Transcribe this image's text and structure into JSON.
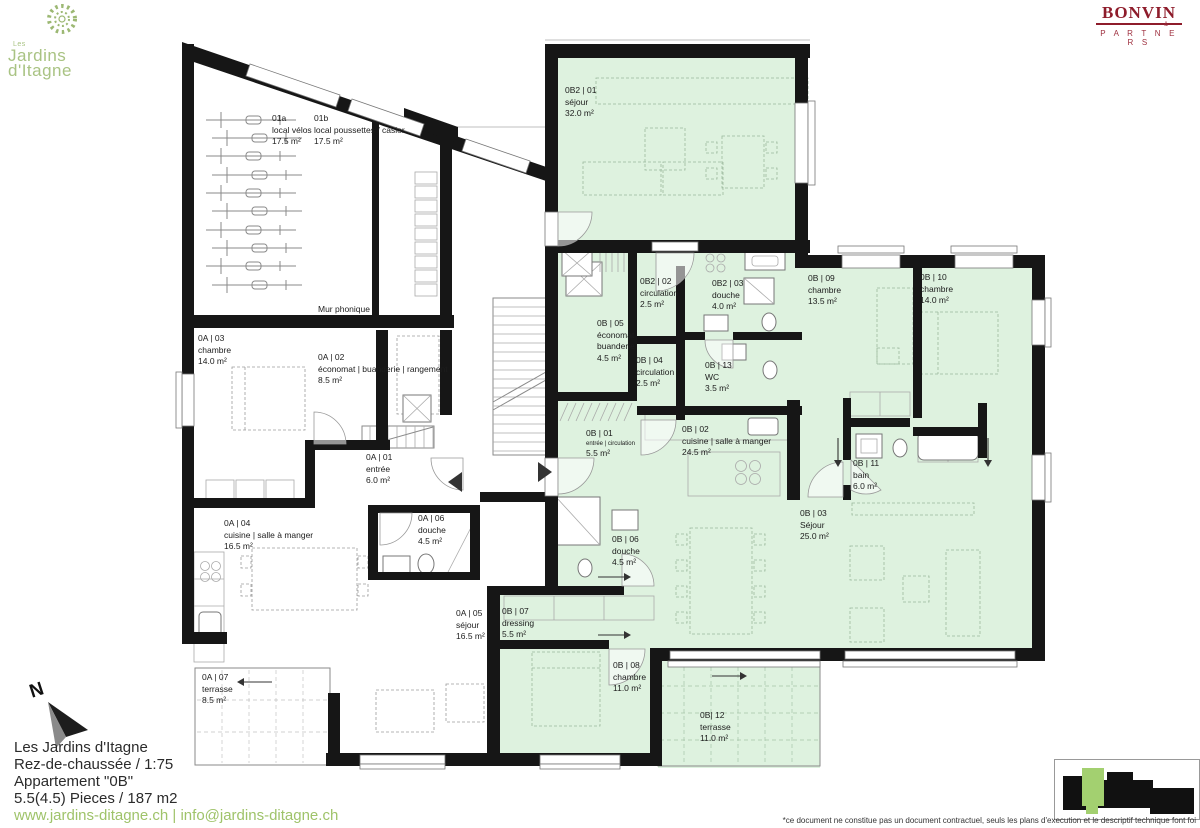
{
  "branding": {
    "site": {
      "prefix": "Les",
      "line1": "Jardins",
      "line2": "d'Itagne"
    },
    "architect": {
      "name": "BONVIN",
      "amp": "&",
      "sub": "P A R T N E R S"
    }
  },
  "title_block": {
    "project": "Les Jardins d'Itagne",
    "floor_scale": "Rez-de-chaussée / 1:75",
    "apartment": "Appartement \"0B\"",
    "size": "5.5(4.5) Pieces / 187 m2",
    "contact": "www.jardins-ditagne.ch | info@jardins-ditagne.ch"
  },
  "disclaimer": "*ce document ne constitue pas un document contractuel, seuls les plans d'execution et le descriptif technique font foi",
  "plan": {
    "north_label": "N",
    "wall_note": "Mur phonique",
    "rooms": [
      {
        "code": "01a",
        "name": "local vélos",
        "area": "17.5 m²"
      },
      {
        "code": "01b",
        "name": "local poussettes / casier",
        "area": "17.5 m²"
      },
      {
        "code": "0A | 03",
        "name": "chambre",
        "area": "14.0 m²"
      },
      {
        "code": "0A | 02",
        "name": "économat | buanderie | rangement",
        "area": "8.5 m²"
      },
      {
        "code": "0A | 01",
        "name": "entrée",
        "area": "6.0 m²"
      },
      {
        "code": "0A | 04",
        "name": "cuisine | salle à manger",
        "area": "16.5 m²"
      },
      {
        "code": "0A | 06",
        "name": "douche",
        "area": "4.5 m²"
      },
      {
        "code": "0A | 05",
        "name": "séjour",
        "area": "16.5 m²"
      },
      {
        "code": "0A | 07",
        "name": "terrasse",
        "area": "8.5 m²"
      },
      {
        "code": "0B2 | 01",
        "name": "séjour",
        "area": "32.0 m²"
      },
      {
        "code": "0B2 | 02",
        "name": "circulation",
        "area": "2.5 m²"
      },
      {
        "code": "0B2 | 03",
        "name": "douche",
        "area": "4.0 m²"
      },
      {
        "code": "0B | 05",
        "name": "économat",
        "name2": "buanderie",
        "area": "4.5 m²"
      },
      {
        "code": "0B | 04",
        "name": "circulation",
        "area": "2.5 m²"
      },
      {
        "code": "0B | 13",
        "name": "WC",
        "area": "3.5 m²"
      },
      {
        "code": "0B | 01",
        "name": "entrée | circulation",
        "area": "5.5 m²"
      },
      {
        "code": "0B | 02",
        "name": "cuisine | salle à manger",
        "area": "24.5 m²"
      },
      {
        "code": "0B | 09",
        "name": "chambre",
        "area": "13.5 m²"
      },
      {
        "code": "0B | 10",
        "name": "chambre",
        "area": "14.0 m²"
      },
      {
        "code": "0B | 11",
        "name": "bain",
        "area": "6.0 m²"
      },
      {
        "code": "0B | 03",
        "name": "Séjour",
        "area": "25.0 m²"
      },
      {
        "code": "0B | 06",
        "name": "douche",
        "area": "4.5 m²"
      },
      {
        "code": "0B | 07",
        "name": "dressing",
        "area": "5.5 m²"
      },
      {
        "code": "0B | 08",
        "name": "chambre",
        "area": "11.0 m²"
      },
      {
        "code": "0B| 12",
        "name": "terrasse",
        "area": "11.0 m²"
      }
    ]
  },
  "colors": {
    "apartment_fill": "#def2df",
    "wall": "#161616",
    "keyplan_highlight": "#a3d070",
    "brand_green": "#a9c383",
    "architect_red": "#8e1c2b",
    "link_green": "#9fc36a"
  }
}
